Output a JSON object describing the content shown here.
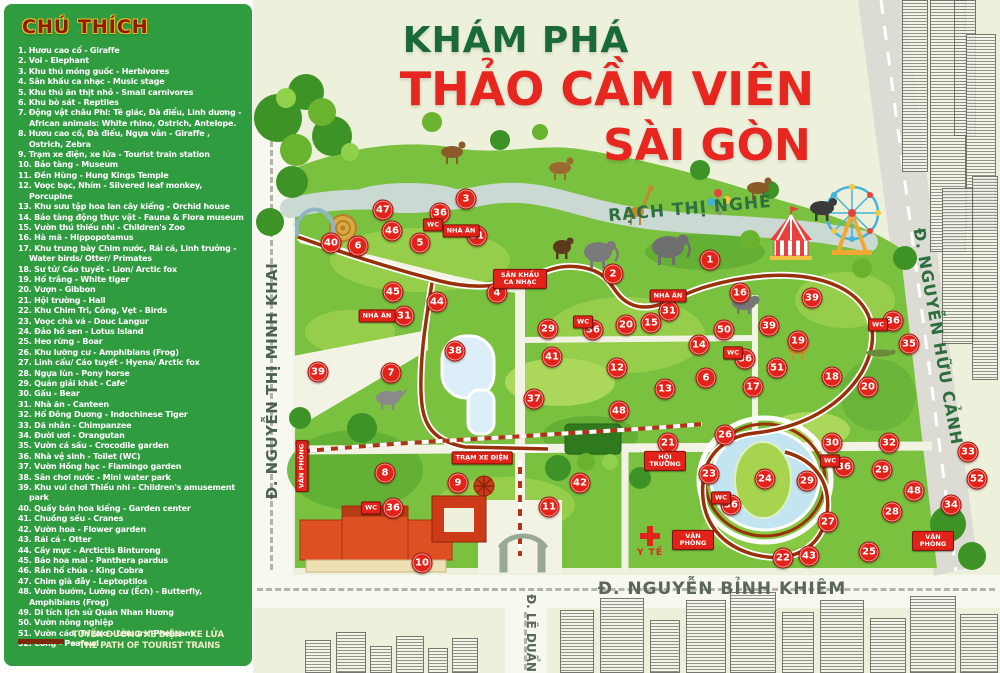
{
  "header": {
    "title_line1": "KHÁM PHÁ",
    "title_line2": "THẢO CẦM VIÊN",
    "title_line3": "SÀI GÒN"
  },
  "sidebar": {
    "title": "CHÚ THÍCH",
    "items": [
      "1. Hươu cao cổ - Giraffe",
      "2. Voi - Elephant",
      "3. Khu thú móng guốc - Herbivores",
      "4. Sân khấu ca nhạc - Music stage",
      "5. Khu thú ăn thịt nhỏ - Small carnivores",
      "6. Khu bò sát - Reptiles",
      "7. Động vật châu Phi: Tê giác, Đà điểu, Linh dương - African animals: White rhino, Ostrich, Antelope.",
      "8. Hươu cao cổ, Đà điểu, Ngựa vằn - Giraffe , Ostrich, Zebra",
      "9. Trạm xe điện, xe lửa - Tourist train station",
      "10. Bảo tàng - Museum",
      "11. Đền Hùng - Hung Kings Temple",
      "12. Voọc bạc, Nhím - Silvered leaf monkey, Porcupine",
      "13. Khu sưu tập hoa lan cây kiểng - Orchid house",
      "14. Bảo tàng động thực vật - Fauna & Flora museum",
      "15. Vườn thú thiếu nhi - Children's Zoo",
      "16. Hà mã - Hippopotamus",
      "17. Khu trưng bày Chim nước, Rái cá, Linh trưởng - Water birds/ Otter/ Primates",
      "18. Sư tử/ Cáo tuyết - Lion/ Arctic fox",
      "19. Hổ trắng - White tiger",
      "20. Vượn - Gibbon",
      "21. Hội trường - Hall",
      "22. Khu Chim Trĩ, Công, Vẹt - Birds",
      "23. Voọc chà vá - Douc Langur",
      "24. Đảo hồ sen - Lotus Island",
      "25. Heo rừng - Boar",
      "26. Khu lưỡng cư - Amphibians (Frog)",
      "27. Linh cẩu/ Cáo tuyết - Hyena/ Arctic fox",
      "28. Ngựa lùn - Pony horse",
      "29. Quán giải khát - Cafe'",
      "30. Gấu - Bear",
      "31. Nhà ăn - Canteen",
      "32. Hổ Đông Dương - Indochinese Tiger",
      "33. Dã nhân - Chimpanzee",
      "34. Đười ươi - Orangutan",
      "35. Vườn cá sấu - Crocodile garden",
      "36. Nhà vệ sinh - Toilet (WC)",
      "37. Vườn Hồng hạc - Flamingo garden",
      "38. Sân chơi nước - Mini water park",
      "39. Khu vui chơi Thiếu nhi - Children's amusement park",
      "40. Quầy bán hoa kiểng - Garden center",
      "41. Chuồng sếu - Cranes",
      "42. Vườn hoa - Flower garden",
      "43. Rái cá - Otter",
      "44. Cầy mực - Arctictis Binturong",
      "45. Báo hoa mai - Panthera pardus",
      "46. Rắn hổ chúa - King Cobra",
      "47. Chim già đẫy - Leptoptilos",
      "48. Vườn bướm, Lưỡng cư (Ếch) - Butterfly, Amphibians (Frog)",
      "49. Di tích lịch sử Quán Nhan Hương",
      "50. Vườn nông nghiệp",
      "51. Vườn cáo, Trĩ sao - Lemurs/ Pheasant",
      "52. Công - Peafowl"
    ],
    "train_legend_line1": "TUYẾN ĐƯỜNG XE ĐIỆN - XE LỬA",
    "train_legend_line2": "* THE PATH OF TOURIST TRAINS"
  },
  "map": {
    "river_label": "RẠCH THỊ NGHÈ",
    "medical_label": "Y TẾ",
    "streets": {
      "left": "Đ. NGUYỄN THỊ MINH KHAI",
      "right": "Đ. NGUYỄN HỮU CẢNH",
      "bottom": "Đ. NGUYỄN BỈNH KHIÊM",
      "bottom_left": "Đ. LÊ DUẨN"
    },
    "markers": [
      {
        "n": 1,
        "x": 710,
        "y": 260
      },
      {
        "n": 2,
        "x": 613,
        "y": 274
      },
      {
        "n": 3,
        "x": 466,
        "y": 199
      },
      {
        "n": 4,
        "x": 497,
        "y": 293
      },
      {
        "n": 5,
        "x": 420,
        "y": 243
      },
      {
        "n": 6,
        "x": 358,
        "y": 246
      },
      {
        "n": 6,
        "x": 706,
        "y": 378
      },
      {
        "n": 7,
        "x": 391,
        "y": 373
      },
      {
        "n": 8,
        "x": 385,
        "y": 473
      },
      {
        "n": 9,
        "x": 458,
        "y": 483
      },
      {
        "n": 10,
        "x": 422,
        "y": 563
      },
      {
        "n": 11,
        "x": 549,
        "y": 507
      },
      {
        "n": 12,
        "x": 617,
        "y": 368
      },
      {
        "n": 13,
        "x": 665,
        "y": 389
      },
      {
        "n": 14,
        "x": 699,
        "y": 345
      },
      {
        "n": 15,
        "x": 651,
        "y": 323
      },
      {
        "n": 16,
        "x": 740,
        "y": 293
      },
      {
        "n": 17,
        "x": 753,
        "y": 387
      },
      {
        "n": 18,
        "x": 832,
        "y": 377
      },
      {
        "n": 19,
        "x": 798,
        "y": 341
      },
      {
        "n": 20,
        "x": 626,
        "y": 325
      },
      {
        "n": 20,
        "x": 868,
        "y": 387
      },
      {
        "n": 21,
        "x": 668,
        "y": 443
      },
      {
        "n": 22,
        "x": 783,
        "y": 558
      },
      {
        "n": 23,
        "x": 709,
        "y": 474
      },
      {
        "n": 24,
        "x": 765,
        "y": 479
      },
      {
        "n": 25,
        "x": 869,
        "y": 552
      },
      {
        "n": 26,
        "x": 725,
        "y": 435
      },
      {
        "n": 27,
        "x": 828,
        "y": 522
      },
      {
        "n": 28,
        "x": 892,
        "y": 512
      },
      {
        "n": 29,
        "x": 548,
        "y": 329
      },
      {
        "n": 29,
        "x": 807,
        "y": 481
      },
      {
        "n": 29,
        "x": 882,
        "y": 470
      },
      {
        "n": 30,
        "x": 832,
        "y": 443
      },
      {
        "n": 31,
        "x": 477,
        "y": 236
      },
      {
        "n": 31,
        "x": 404,
        "y": 316
      },
      {
        "n": 31,
        "x": 669,
        "y": 311
      },
      {
        "n": 32,
        "x": 889,
        "y": 443
      },
      {
        "n": 33,
        "x": 968,
        "y": 452
      },
      {
        "n": 34,
        "x": 951,
        "y": 505
      },
      {
        "n": 35,
        "x": 909,
        "y": 344
      },
      {
        "n": 36,
        "x": 440,
        "y": 213
      },
      {
        "n": 36,
        "x": 593,
        "y": 330
      },
      {
        "n": 36,
        "x": 893,
        "y": 321
      },
      {
        "n": 36,
        "x": 745,
        "y": 359
      },
      {
        "n": 36,
        "x": 393,
        "y": 508
      },
      {
        "n": 36,
        "x": 731,
        "y": 505
      },
      {
        "n": 36,
        "x": 844,
        "y": 467
      },
      {
        "n": 37,
        "x": 534,
        "y": 399
      },
      {
        "n": 38,
        "x": 455,
        "y": 351
      },
      {
        "n": 39,
        "x": 318,
        "y": 372
      },
      {
        "n": 39,
        "x": 812,
        "y": 298
      },
      {
        "n": 39,
        "x": 769,
        "y": 326
      },
      {
        "n": 40,
        "x": 331,
        "y": 243
      },
      {
        "n": 41,
        "x": 552,
        "y": 357
      },
      {
        "n": 42,
        "x": 580,
        "y": 483
      },
      {
        "n": 43,
        "x": 809,
        "y": 556
      },
      {
        "n": 44,
        "x": 437,
        "y": 302
      },
      {
        "n": 45,
        "x": 393,
        "y": 292
      },
      {
        "n": 46,
        "x": 392,
        "y": 231
      },
      {
        "n": 47,
        "x": 383,
        "y": 210
      },
      {
        "n": 48,
        "x": 619,
        "y": 411
      },
      {
        "n": 48,
        "x": 914,
        "y": 491
      },
      {
        "n": 50,
        "x": 724,
        "y": 330
      },
      {
        "n": 51,
        "x": 777,
        "y": 368
      },
      {
        "n": 52,
        "x": 977,
        "y": 479
      }
    ],
    "signs": [
      {
        "label": "NHÀ ĂN",
        "x": 461,
        "y": 231
      },
      {
        "label": "NHÀ ĂN",
        "x": 377,
        "y": 316
      },
      {
        "label": "NHÀ ĂN",
        "x": 668,
        "y": 296
      },
      {
        "label": "WC",
        "x": 433,
        "y": 225
      },
      {
        "label": "WC",
        "x": 583,
        "y": 322
      },
      {
        "label": "WC",
        "x": 878,
        "y": 325
      },
      {
        "label": "WC",
        "x": 733,
        "y": 353
      },
      {
        "label": "WC",
        "x": 371,
        "y": 508
      },
      {
        "label": "WC",
        "x": 721,
        "y": 498
      },
      {
        "label": "WC",
        "x": 830,
        "y": 461
      },
      {
        "label": "VĂN PHÒNG",
        "x": 302,
        "y": 466,
        "v": true,
        "w": 50
      },
      {
        "label": "VĂN PHÒNG",
        "x": 693,
        "y": 540,
        "w": 34
      },
      {
        "label": "VĂN PHÒNG",
        "x": 933,
        "y": 541,
        "w": 34
      },
      {
        "label": "HỘI TRƯỜNG",
        "x": 665,
        "y": 461,
        "w": 34
      },
      {
        "label": "SÂN KHẤU CA NHẠC",
        "x": 520,
        "y": 279,
        "w": 46
      },
      {
        "label": "TRẠM XE ĐIỆN",
        "x": 482,
        "y": 458,
        "w": 70
      }
    ]
  },
  "colors": {
    "sidebar_green": "#2e9c3f",
    "title_green": "#1a6a38",
    "title_red": "#e6261f",
    "marker_red": "#e2231a",
    "park_green": "#7bc140",
    "tram_path": "#993108",
    "map_background": "#edf0da"
  }
}
